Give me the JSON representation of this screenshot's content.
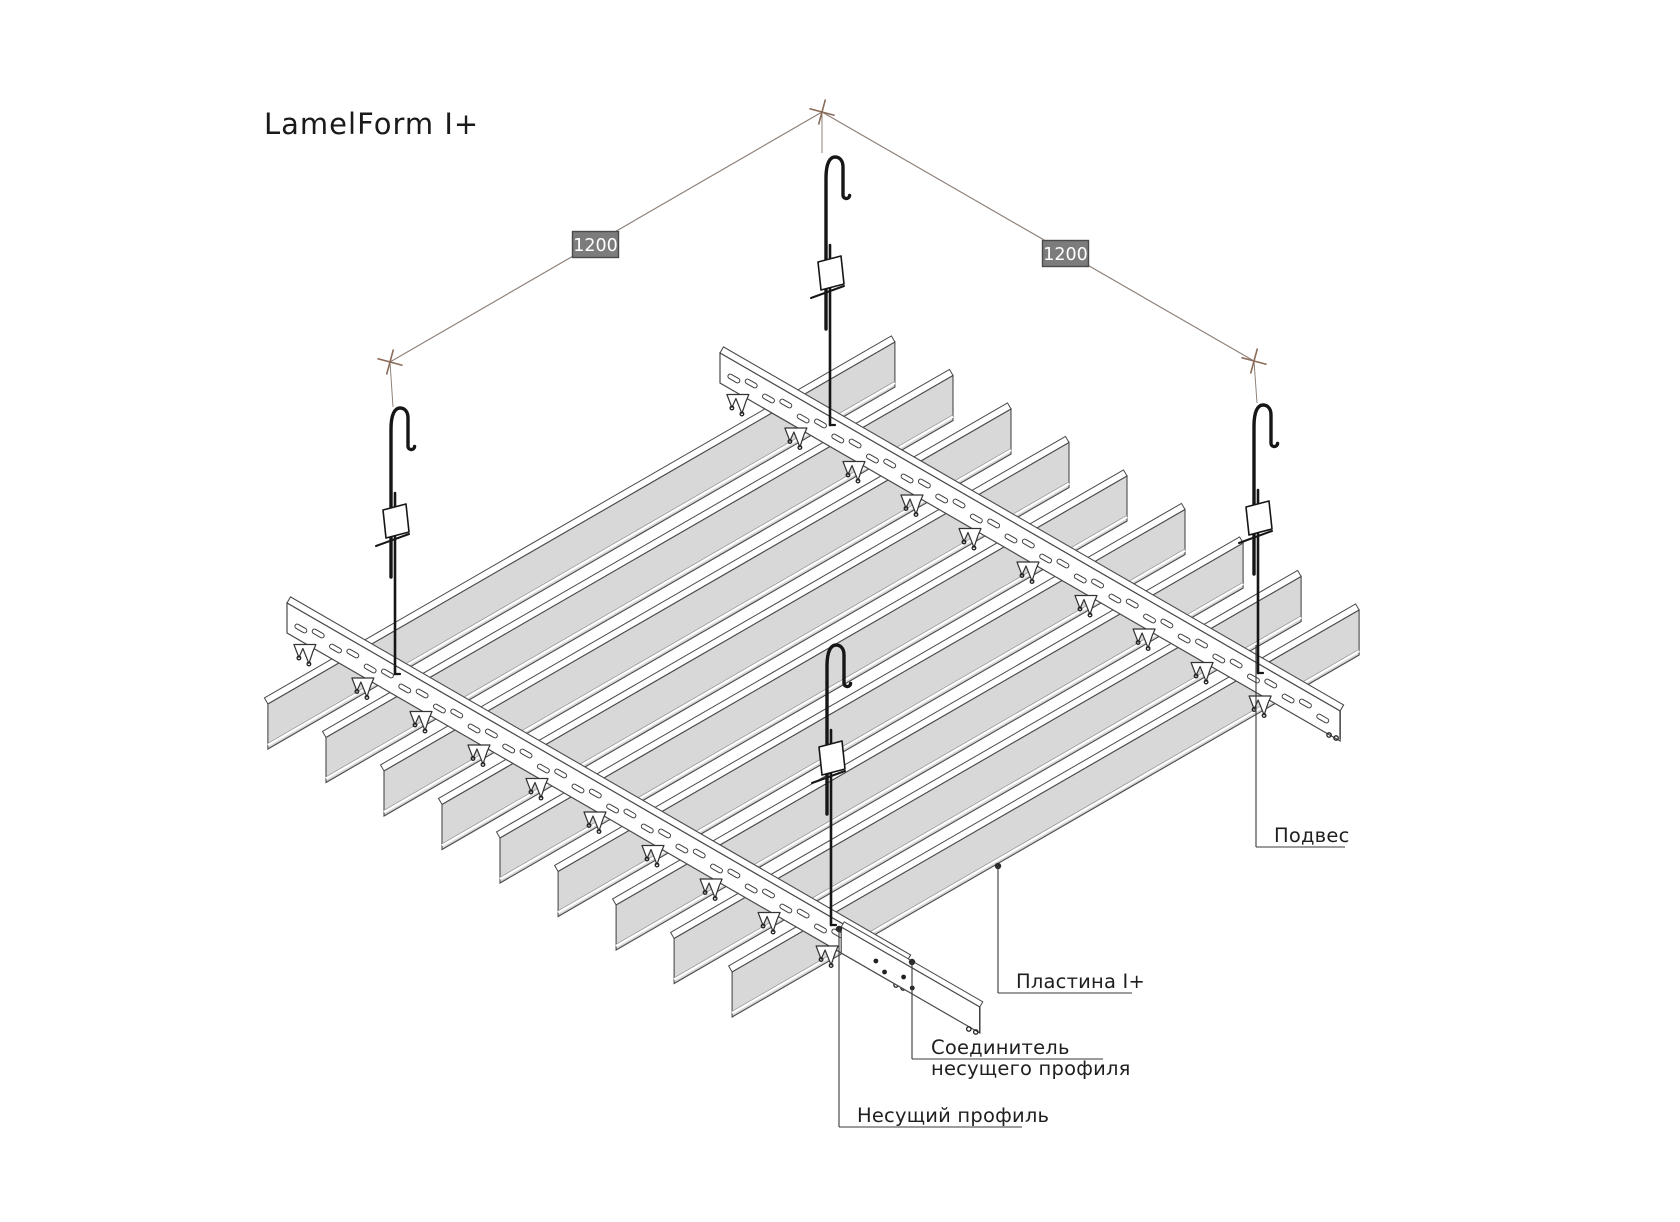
{
  "title": "LamelForm I+",
  "dimensions": {
    "left": "1200",
    "right": "1200"
  },
  "labels": {
    "hanger": "Подвес",
    "plate": "Пластина I+",
    "connector_line1": "Соединитель",
    "connector_line2": "несущего профиля",
    "profile": "Несущий профиль"
  },
  "icons": {
    "hanger_hook": "hook-icon",
    "leader_dot": "leader-dot"
  },
  "colors": {
    "background": "#ffffff",
    "outline": "#4a4a4a",
    "lamella_fill": "#d8d8d8",
    "rail_fill": "#ffffff",
    "hanger_stroke": "#161616",
    "dim_line": "#8f837b",
    "dim_tick": "#8a6a58",
    "dim_box_fill": "#7c7c7c",
    "dim_box_stroke": "#4a4a4a",
    "dim_text": "#ffffff",
    "leader_line": "#3a3a3a",
    "label_text": "#1f1f1f",
    "title_text": "#1a1a1a"
  }
}
